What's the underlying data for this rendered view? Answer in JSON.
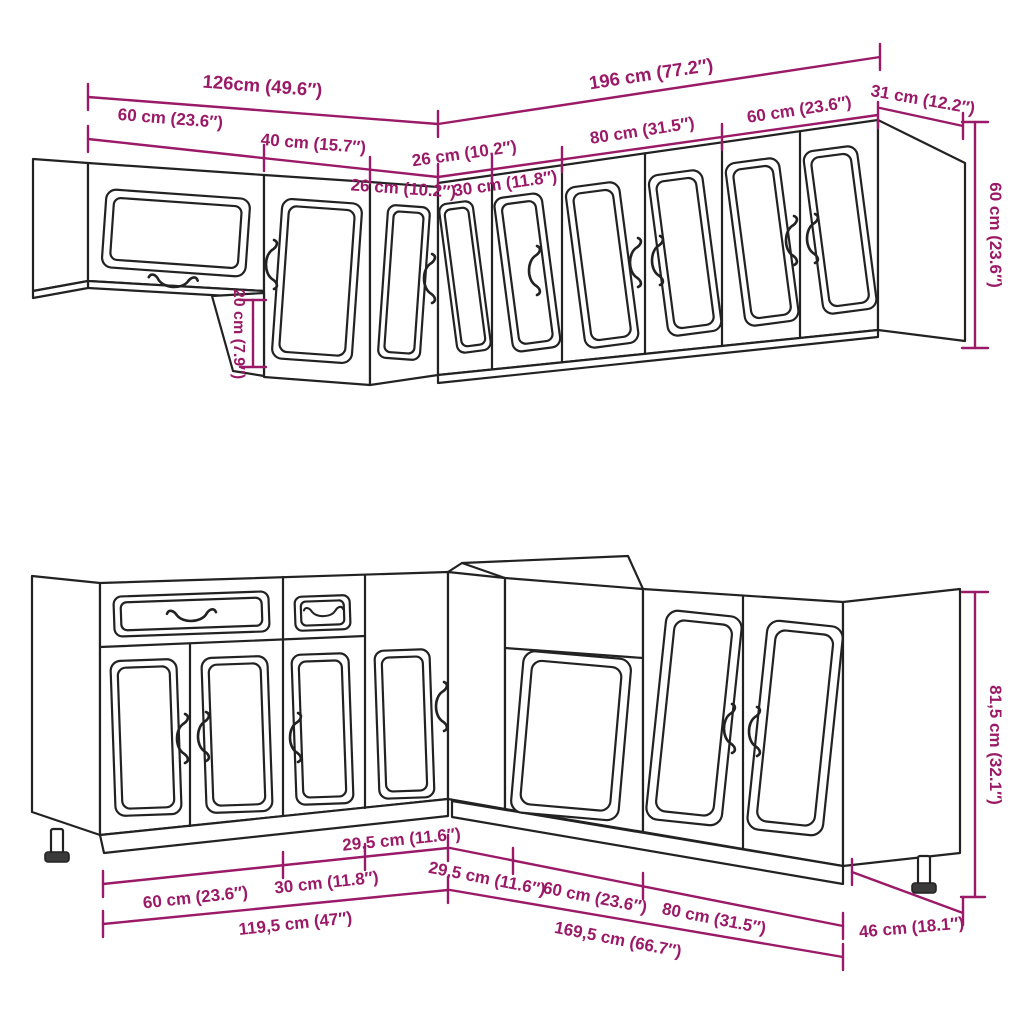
{
  "figure": {
    "kind": "kitchen cabinet set dimension diagram",
    "views": [
      "wall cabinets (top)",
      "base cabinets (bottom)"
    ]
  },
  "colors": {
    "dimension": "#9a1a68",
    "outline": "#222222",
    "background": "#ffffff"
  },
  "wall": {
    "overall_left": "126cm (49.6″)",
    "overall_right": "196 cm (77.2″)",
    "w60_left": "60 cm (23.6″)",
    "w40": "40 cm (15.7″)",
    "w26_corner": "26 cm (10.2″)",
    "w26_left": "26 cm (10.2″)",
    "w30": "30 cm (11.8″)",
    "w80": "80 cm (31.5″)",
    "w60_right": "60 cm (23.6″)",
    "depth31": "31 cm (12.2″)",
    "height60": "60 cm (23.6″)",
    "step20": "20 cm (7.9″)"
  },
  "base": {
    "c295_left": "29,5 cm (11.6″)",
    "b60_left": "60 cm (23.6″)",
    "b30": "30 cm (11.8″)",
    "total1195": "119,5 cm (47″)",
    "c295_right": "29,5 cm (11.6″)",
    "b60_right": "60 cm (23.6″)",
    "b80": "80 cm (31.5″)",
    "total1695": "169,5 cm (66.7″)",
    "depth46": "46 cm (18.1″)",
    "height815": "81,5 cm (32.1″)"
  }
}
